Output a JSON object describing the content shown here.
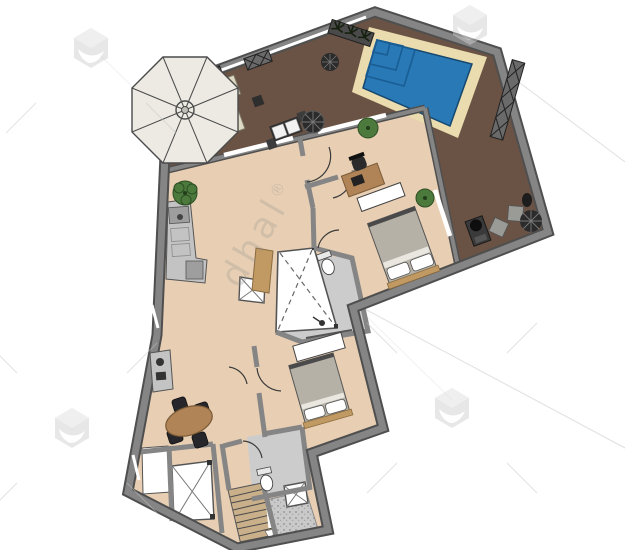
{
  "watermark": {
    "text": "dhal",
    "mark": "®",
    "logo": "cube-logo"
  },
  "palette": {
    "wall": "#858585",
    "wall_edge": "#4f4f4f",
    "deck": "#6a5344",
    "floor": "#e8cfb3",
    "floor_gray": "#cccccc",
    "pool_deck": "#eadcae",
    "pool_water": "#2879b6",
    "pool_line": "#1a5d94",
    "dark": "#2e2e2e",
    "wood": "#c19a63",
    "table_wood": "#b08457",
    "bed": "#b5b1a6",
    "plant": "#4c7a3c",
    "plant_dark": "#2d4d24",
    "stairs": "#c9af8a",
    "counter": "#c3c3c3",
    "lounger": "#ded9c3",
    "parasol": "#eceae3",
    "arc": "#3a3a3a",
    "speckle": "#c9c9c9",
    "cube": "#cfcfcf",
    "wm_line": "#c7c7c7",
    "wm_text": "#8f8f8f"
  }
}
